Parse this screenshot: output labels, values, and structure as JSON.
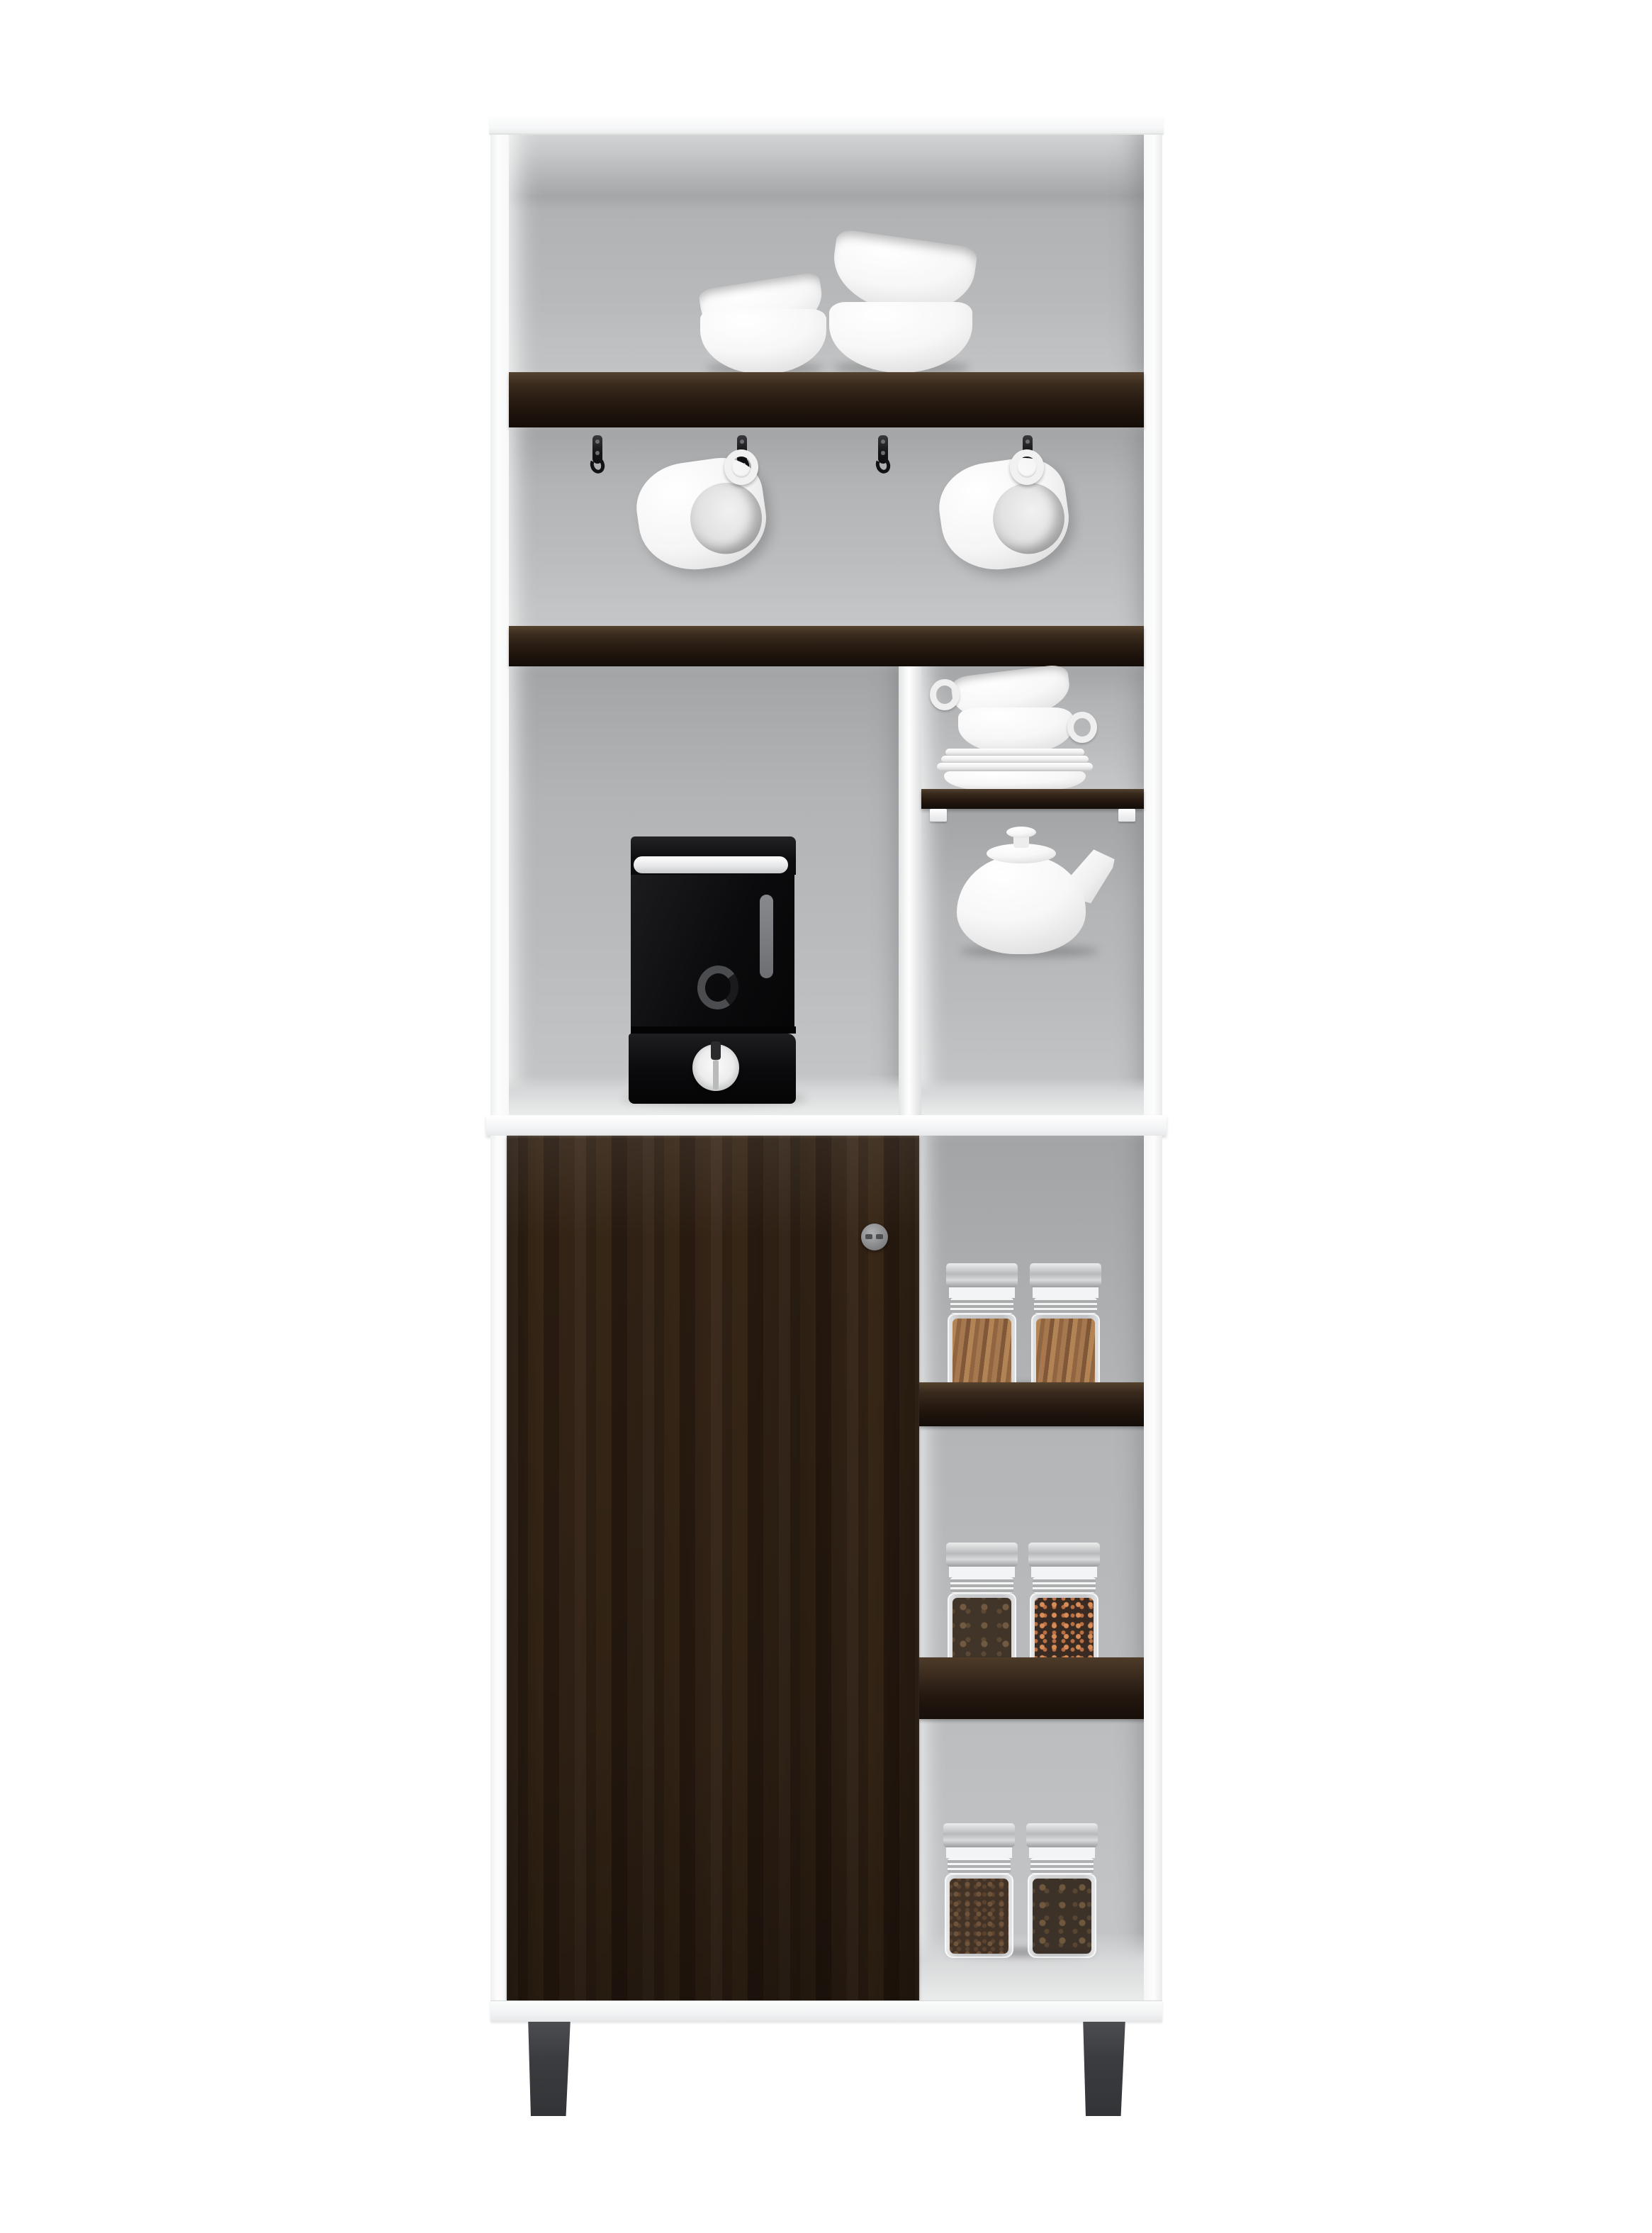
{
  "scene": {
    "type": "product-photo",
    "subject": "Tall white kitchen coffee-bar pantry cabinet with espresso wood accents",
    "background_color": "#ffffff",
    "aria": {
      "cabinet": "white pantry cabinet with dark wood shelves and door",
      "top_cubby": "open top cubby with two stacks of white bowls",
      "hook_rail": "rail section with four black hooks and two hanging white mugs",
      "coffee_cubby": "cubby holding a black single-serve coffee machine",
      "dish_cell": "small cell with stacked white teacups and saucers",
      "teapot_cell": "small cell with a white porcelain teapot",
      "door": "dark espresso wood cabinet door with round metal knob",
      "spice_column": "open side column with glass spice jars on dark shelves",
      "legs": "two dark gray splayed cabinet legs"
    }
  },
  "palette": {
    "cabinet_white": "#fbfcfc",
    "interior_gray": "#b7b9bb",
    "wood_dark": "#2c1f14",
    "wood_grain_light": "#4a3524",
    "counter_white": "#f4f5f6",
    "leg_gray": "#3b3d40",
    "porcelain_white": "#f7f7f7",
    "appliance_black": "#0d0d0f",
    "dial_silver": "#e0e0e1",
    "hook_black": "#141417",
    "jar_lid_silver": "#c9cbcd",
    "cinnamon": "#a1703f",
    "star_anise": "#5e4630",
    "peppercorn_orange": "#cf7f4a",
    "coffee_bean_brown": "#55402e"
  },
  "objects": {
    "bowl_stack_small": "two nested white bowls, tilted",
    "bowl_stack_large": "two nested large white bowls, tilted",
    "hooks": [
      "hook 1",
      "hook 2",
      "hook 3",
      "hook 4"
    ],
    "mugs": [
      "white mug hanging on hook 2",
      "white mug hanging on hook 4"
    ],
    "coffee_machine": "black capsule coffee machine with silver dial",
    "teacups": "two stacked white teacups with handles",
    "saucers": "stack of four white saucers on small wood shelf",
    "teapot": "round white teapot with lid and spout",
    "jars_shelf_1": [
      "glass jar with cinnamon sticks",
      "glass jar with cinnamon sticks"
    ],
    "jars_shelf_2": [
      "glass jar with star anise",
      "glass jar with orange peppercorns"
    ],
    "jars_bottom": [
      "glass jar with coffee beans",
      "glass jar with star anise"
    ],
    "door_knob": "round gunmetal knob"
  }
}
